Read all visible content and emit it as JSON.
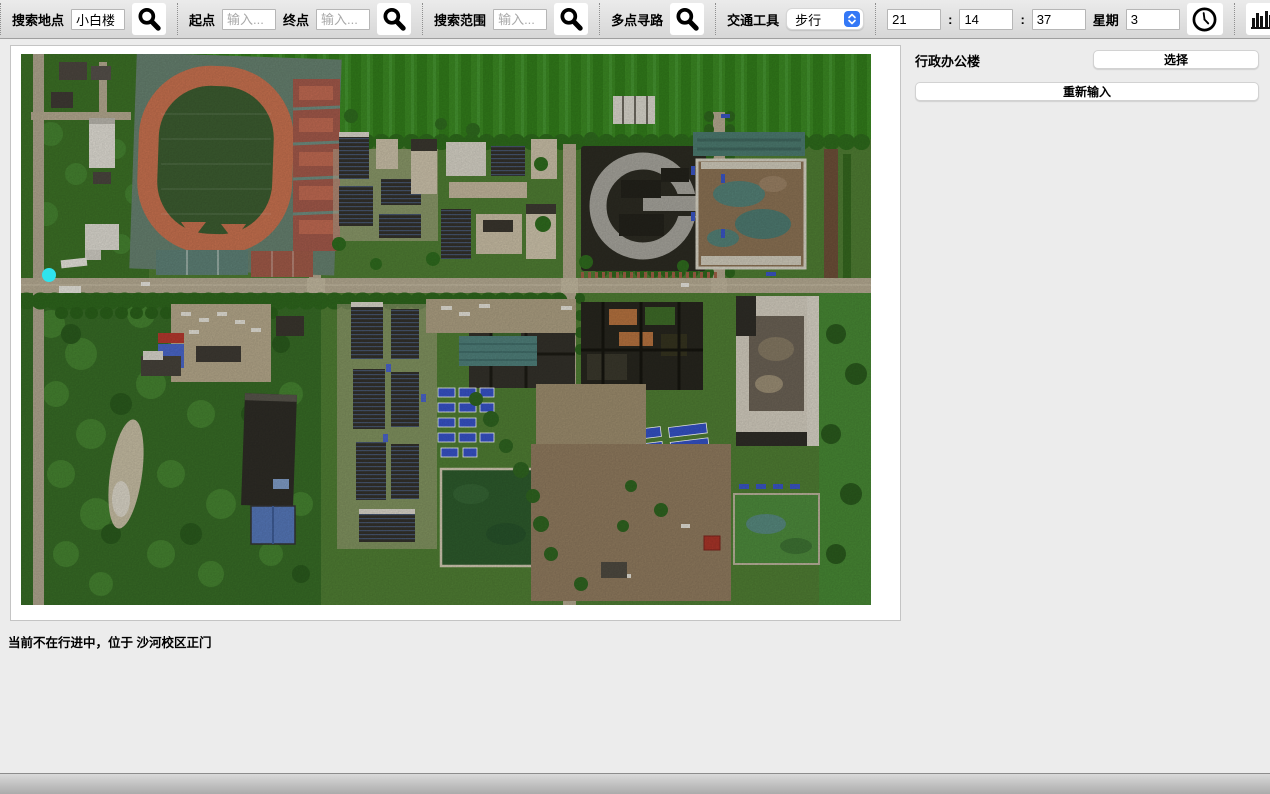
{
  "colors": {
    "page-bg": "#ececec",
    "toolbar-top": "#ebebeb",
    "toolbar-bottom": "#d7d7d7",
    "accent-blue": "#3478f6",
    "marker-cyan": "#2fe3ee"
  },
  "toolbar": {
    "search_place": {
      "label": "搜索地点",
      "value": "小白楼"
    },
    "route": {
      "start_label": "起点",
      "start_placeholder": "输入...",
      "end_label": "终点",
      "end_placeholder": "输入..."
    },
    "search_range": {
      "label": "搜索范围",
      "placeholder": "输入..."
    },
    "multi_point_label": "多点寻路",
    "transport": {
      "label": "交通工具",
      "value": "步行"
    },
    "time": {
      "hour": "21",
      "colon1": ":",
      "minute": "14",
      "colon2": ":",
      "second": "37",
      "week_label": "星期",
      "week_value": "3"
    },
    "icon_names": [
      "search-icon",
      "clock-icon",
      "bar-chart-icon",
      "building-locator-icon",
      "swap-routes-icon",
      "presenter-icon",
      "notepad-icon"
    ]
  },
  "panel": {
    "building_name": "行政办公楼",
    "select_label": "选择",
    "reinput_label": "重新输入"
  },
  "status_bar": {
    "text": "当前不在行进中，位于 沙河校区正门"
  },
  "map": {
    "marker_name": "current-location-marker",
    "location": "沙河校区正门"
  }
}
